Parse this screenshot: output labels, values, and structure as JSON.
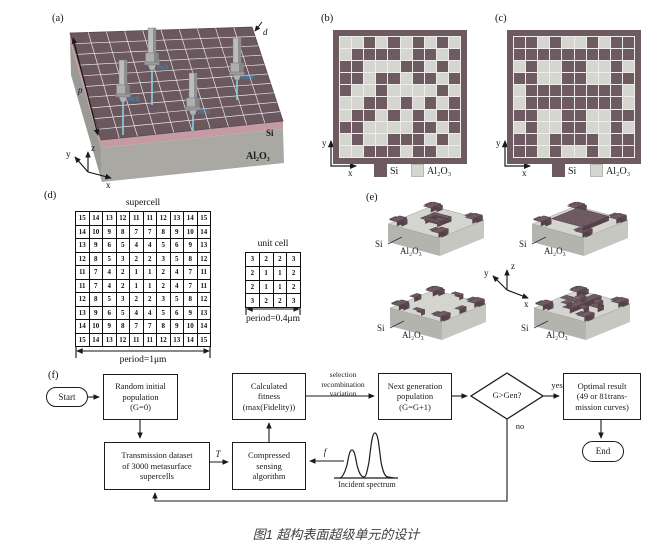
{
  "caption": "图1 超构表面超级单元的设计",
  "colors": {
    "si": "#6e5a61",
    "al2o3": "#d6d6d0",
    "frame": "#6e5a61",
    "slab_gray": "#a9a8a3",
    "si_band": "#c59ba3",
    "etch_blue": "#2f9ad0",
    "line": "#1a1a1a"
  },
  "panel_a": {
    "label": "(a)",
    "d_label": "d",
    "p_label": "p",
    "si_label": "Si",
    "al2o3_label": "Al₂O₃",
    "etch_label": "etch",
    "axes": {
      "x": "x",
      "y": "y",
      "z": "z"
    }
  },
  "panel_b": {
    "label": "(b)",
    "axes": {
      "x": "x",
      "y": "y"
    },
    "legend": [
      {
        "label": "Si"
      },
      {
        "label": "Al₂O₃"
      }
    ],
    "grid": [
      [
        0,
        0,
        1,
        0,
        1,
        0,
        1,
        0,
        1,
        0
      ],
      [
        0,
        1,
        1,
        1,
        1,
        0,
        1,
        1,
        0,
        1
      ],
      [
        1,
        1,
        0,
        0,
        0,
        1,
        1,
        0,
        1,
        0
      ],
      [
        1,
        1,
        0,
        1,
        1,
        0,
        1,
        1,
        0,
        1
      ],
      [
        1,
        0,
        0,
        1,
        0,
        0,
        0,
        0,
        1,
        0
      ],
      [
        0,
        0,
        1,
        1,
        0,
        1,
        0,
        1,
        0,
        1
      ],
      [
        0,
        1,
        1,
        0,
        1,
        0,
        1,
        0,
        1,
        1
      ],
      [
        1,
        1,
        0,
        0,
        0,
        0,
        1,
        1,
        0,
        1
      ],
      [
        0,
        1,
        0,
        0,
        1,
        1,
        1,
        0,
        1,
        0
      ],
      [
        0,
        0,
        1,
        1,
        1,
        0,
        1,
        1,
        0,
        0
      ]
    ]
  },
  "panel_c": {
    "label": "(c)",
    "axes": {
      "x": "x",
      "y": "y"
    },
    "legend": [
      {
        "label": "Si"
      },
      {
        "label": "Al₂O₃"
      }
    ],
    "grid": [
      [
        1,
        1,
        0,
        1,
        0,
        0,
        1,
        0,
        1,
        1
      ],
      [
        1,
        1,
        1,
        1,
        1,
        1,
        1,
        1,
        1,
        1
      ],
      [
        0,
        1,
        0,
        0,
        1,
        1,
        0,
        0,
        1,
        0
      ],
      [
        1,
        1,
        0,
        0,
        1,
        1,
        0,
        0,
        1,
        1
      ],
      [
        0,
        1,
        1,
        1,
        1,
        1,
        1,
        1,
        1,
        0
      ],
      [
        0,
        1,
        1,
        1,
        1,
        1,
        1,
        1,
        1,
        0
      ],
      [
        1,
        1,
        0,
        0,
        1,
        1,
        0,
        0,
        1,
        1
      ],
      [
        0,
        1,
        0,
        0,
        1,
        1,
        0,
        0,
        1,
        0
      ],
      [
        1,
        1,
        0,
        1,
        1,
        1,
        1,
        0,
        1,
        1
      ],
      [
        1,
        1,
        0,
        1,
        0,
        0,
        1,
        0,
        1,
        1
      ]
    ]
  },
  "panel_d": {
    "label": "(d)",
    "supercell_title": "supercell",
    "supercell_period": "period=1μm",
    "unitcell_title": "unit cell",
    "unitcell_period": "period=0.4μm",
    "supercell": [
      [
        15,
        14,
        13,
        12,
        11,
        11,
        12,
        13,
        14,
        15
      ],
      [
        14,
        10,
        9,
        8,
        7,
        7,
        8,
        9,
        10,
        14
      ],
      [
        13,
        9,
        6,
        5,
        4,
        4,
        5,
        6,
        9,
        13
      ],
      [
        12,
        8,
        5,
        3,
        2,
        2,
        3,
        5,
        8,
        12
      ],
      [
        11,
        7,
        4,
        2,
        1,
        1,
        2,
        4,
        7,
        11
      ],
      [
        11,
        7,
        4,
        2,
        1,
        1,
        2,
        4,
        7,
        11
      ],
      [
        12,
        8,
        5,
        3,
        2,
        2,
        3,
        5,
        8,
        12
      ],
      [
        13,
        9,
        6,
        5,
        4,
        4,
        5,
        6,
        9,
        13
      ],
      [
        14,
        10,
        9,
        8,
        7,
        7,
        8,
        9,
        10,
        14
      ],
      [
        15,
        14,
        13,
        12,
        11,
        11,
        12,
        13,
        14,
        15
      ]
    ],
    "unitcell": [
      [
        3,
        2,
        2,
        3
      ],
      [
        2,
        1,
        1,
        2
      ],
      [
        2,
        1,
        1,
        2
      ],
      [
        3,
        2,
        2,
        3
      ]
    ]
  },
  "panel_e": {
    "label": "(e)",
    "si_label": "Si",
    "al2o3_label": "Al₂O₃",
    "axes": {
      "x": "x",
      "y": "y",
      "z": "z"
    }
  },
  "panel_f": {
    "label": "(f)",
    "nodes": {
      "start": "Start",
      "random": "Random initial\npopulation\n(G=0)",
      "fitness": "Calculated\nfitness\n(max(Fidelity))",
      "next": "Next generation\npopulation\n(G=G+1)",
      "decision": "G>Gen?",
      "optimal": "Optimal result\n(49 or 81trans-\nmission curves)",
      "dataset": "Transmission dataset\nof 3000 metasurface\nsupercells",
      "compressed": "Compressed\nsensing\nalgorithm",
      "end": "End"
    },
    "edge_labels": {
      "selection": "selection\nrecombination\nvariation",
      "yes": "yes",
      "no": "no",
      "T": "T",
      "f": "f",
      "incident": "Incident spectrum"
    }
  }
}
